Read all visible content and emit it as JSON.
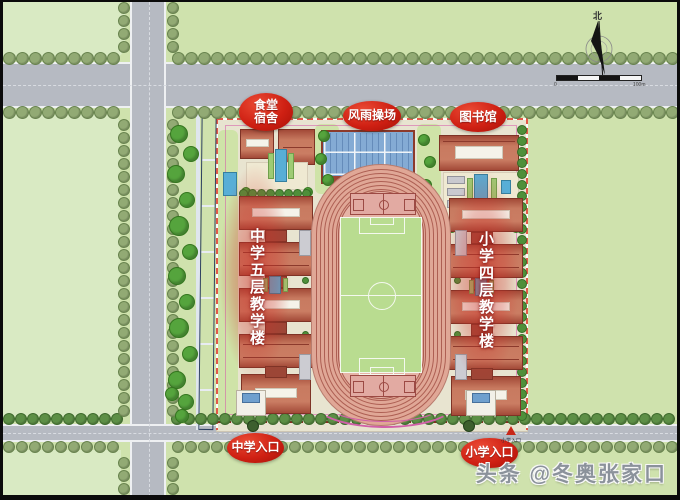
{
  "labels": {
    "canteen_line1": "食堂",
    "canteen_line2": "宿舍",
    "gym": "风雨操场",
    "library": "图书馆",
    "middle_school_building": "中学五层教学楼",
    "primary_school_building": "小学四层教学楼",
    "middle_school_entrance": "中学入口",
    "primary_school_entrance": "小学入口",
    "side_entrance_marker": "小学入口"
  },
  "compass": {
    "north": "北"
  },
  "scale_bar": {
    "start": "0",
    "end": "100m"
  },
  "watermark": {
    "text": "头条 @冬奥张家口"
  },
  "colors": {
    "badge_red": "#cf2013",
    "roof_red": "#b0503c",
    "track_pink": "#e0a796",
    "field_green": "#b9dc90",
    "gym_roof_blue": "#84abd4",
    "road_gray": "#b6bac2",
    "boundary_dash_red": "#e25848",
    "background_green": "#cfe2ad"
  }
}
